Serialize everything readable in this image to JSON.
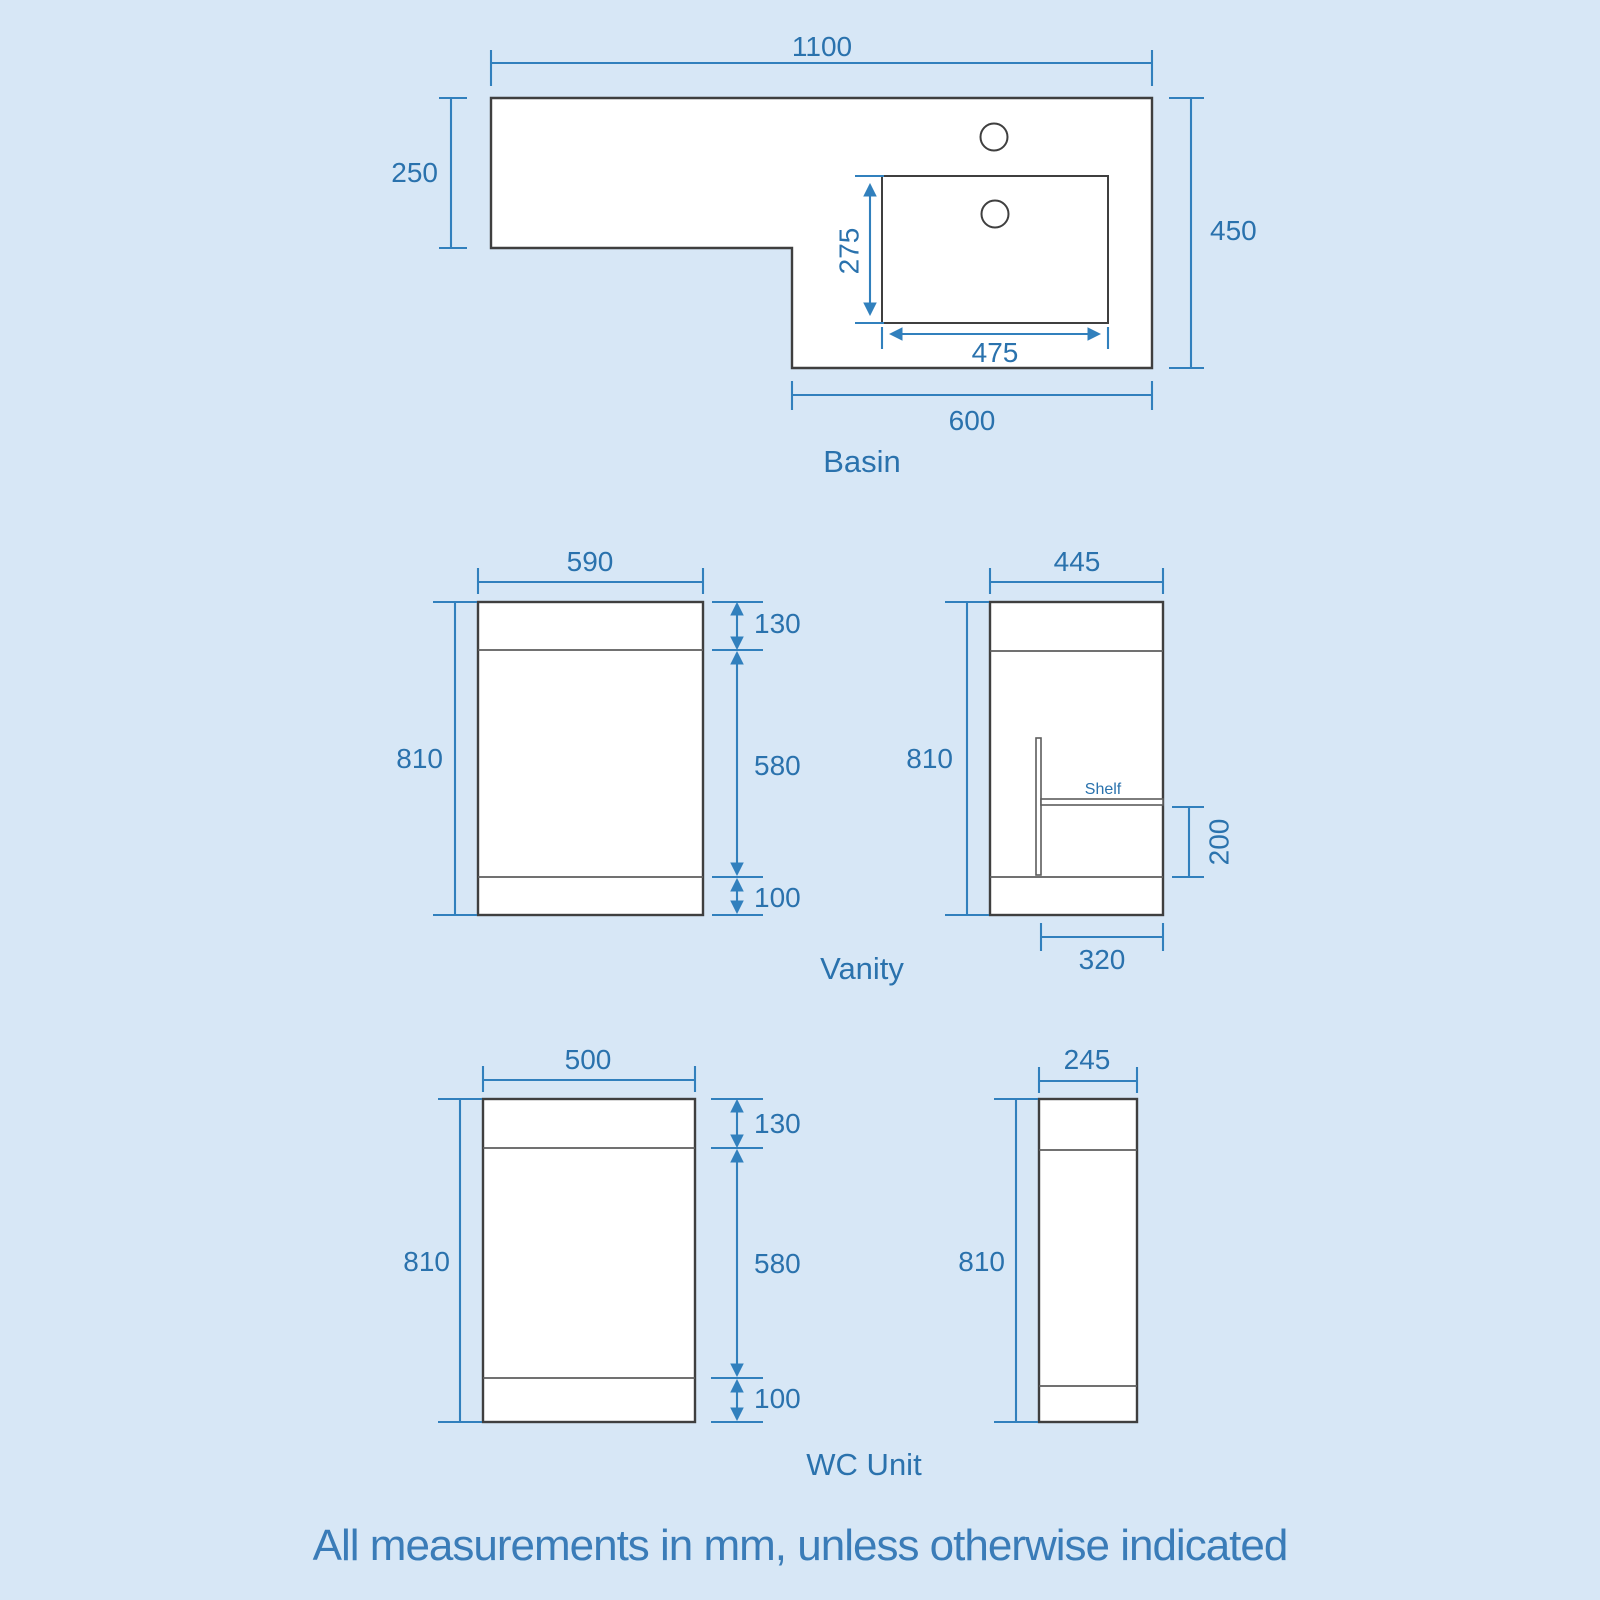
{
  "note": "All measurements in mm, unless otherwise indicated",
  "colors": {
    "background": "#d7e7f6",
    "dimension_blue": "#3180bd",
    "text_blue": "#2a72ad",
    "outline_gray": "#3f3f3f",
    "shape_fill": "#ffffff"
  },
  "basin": {
    "label": "Basin",
    "dims": {
      "overall_width": "1100",
      "left_depth": "250",
      "right_depth": "450",
      "bowl_depth": "275",
      "bowl_width": "475",
      "right_width": "600"
    }
  },
  "vanity": {
    "label": "Vanity",
    "front": {
      "width": "590",
      "height": "810",
      "top_section": "130",
      "door_section": "580",
      "plinth": "100"
    },
    "side": {
      "depth": "445",
      "height": "810",
      "shelf_label": "Shelf",
      "shelf_height": "200",
      "shelf_depth": "320"
    }
  },
  "wc": {
    "label": "WC Unit",
    "front": {
      "width": "500",
      "height": "810",
      "top_section": "130",
      "door_section": "580",
      "plinth": "100"
    },
    "side": {
      "depth": "245",
      "height": "810"
    }
  }
}
